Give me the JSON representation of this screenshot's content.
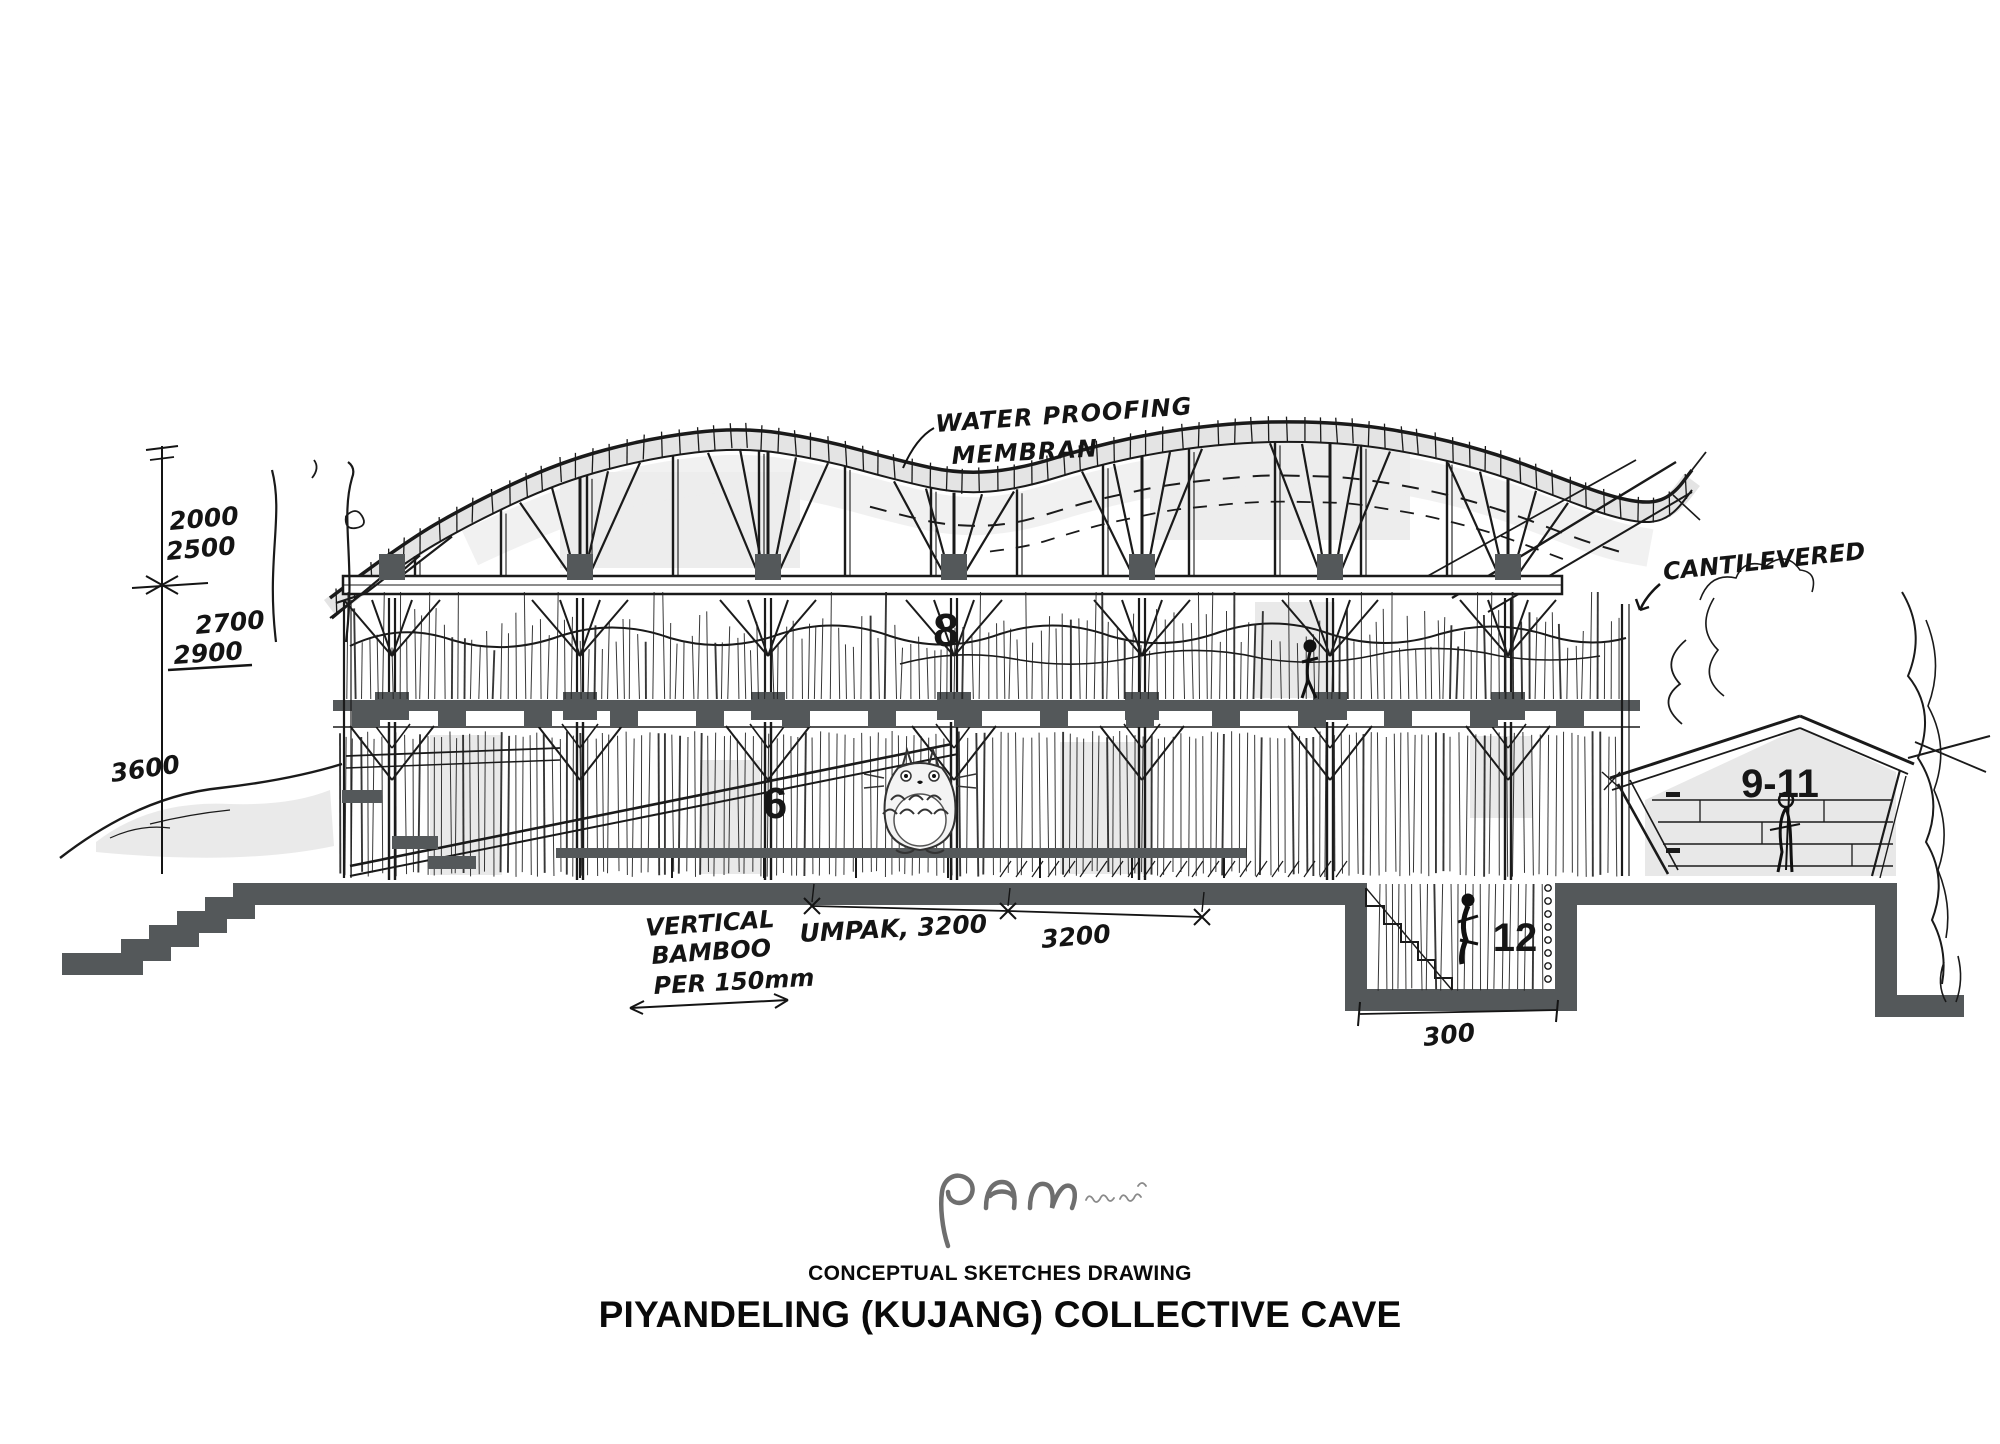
{
  "document": {
    "subtitle": "CONCEPTUAL SKETCHES DRAWING",
    "title": "PIYANDELING (KUJANG) COLLECTIVE CAVE"
  },
  "annotations": {
    "waterproofing_line1": "WATER PROOFING",
    "waterproofing_line2": "MEMBRAN",
    "cantilevered": "CANTILEVERED",
    "vertical_bamboo_line1": "VERTICAL",
    "vertical_bamboo_line2": "BAMBOO",
    "vertical_bamboo_line3": "PER 150mm"
  },
  "dimensions": {
    "roof_upper": "2000",
    "roof_lower": "2500",
    "level_upper": "2700",
    "level_lower": "2900",
    "ground_height": "3600",
    "bay_umpak": "UMPAK, 3200",
    "bay": "3200",
    "pit_width": "300"
  },
  "zones": {
    "upper_floor": "8",
    "main_hall": "6",
    "annex": "9-11",
    "pit": "12"
  },
  "colors": {
    "ink": "#1a1a1a",
    "slab_gray": "#54585a",
    "shade_gray": "#e6e6e6",
    "logo_gray": "#6e6e6e"
  }
}
